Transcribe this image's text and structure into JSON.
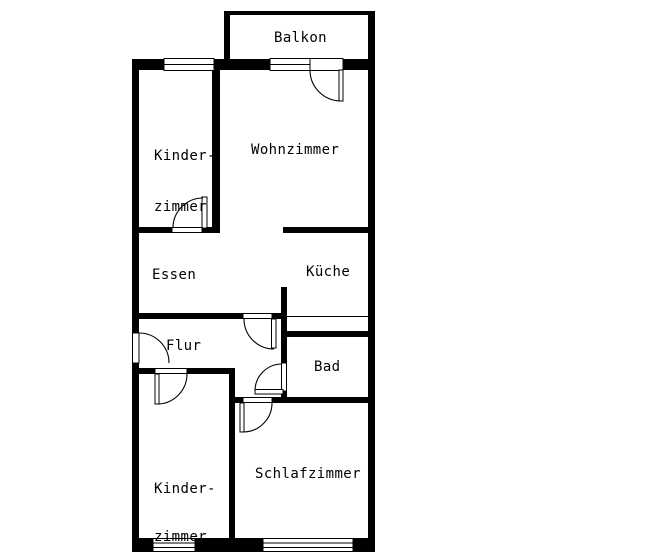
{
  "floorplan": {
    "type": "apartment-floor-plan",
    "colors": {
      "wall": "#000000",
      "background": "#ffffff",
      "text": "#000000"
    },
    "rooms": {
      "balkon": {
        "label": "Balkon"
      },
      "kinderzimmer_top": {
        "line1": "Kinder-",
        "line2": "zimmer"
      },
      "wohnzimmer": {
        "label": "Wohnzimmer"
      },
      "essen": {
        "label": "Essen"
      },
      "kueche": {
        "label": "Küche"
      },
      "flur": {
        "label": "Flur"
      },
      "bad": {
        "label": "Bad"
      },
      "kinderzimmer_bottom": {
        "line1": "Kinder-",
        "line2": "zimmer"
      },
      "schlafzimmer": {
        "label": "Schlafzimmer"
      }
    },
    "features": {
      "doors": [
        "entrance",
        "balcony-door",
        "kinderzimmer-top-door",
        "flur-door",
        "bad-door",
        "kinderzimmer-bottom-door",
        "schlafzimmer-door"
      ],
      "windows": [
        "kinderzimmer-top-window",
        "balkon-window",
        "kinderzimmer-bottom-window",
        "schlafzimmer-window"
      ]
    }
  }
}
